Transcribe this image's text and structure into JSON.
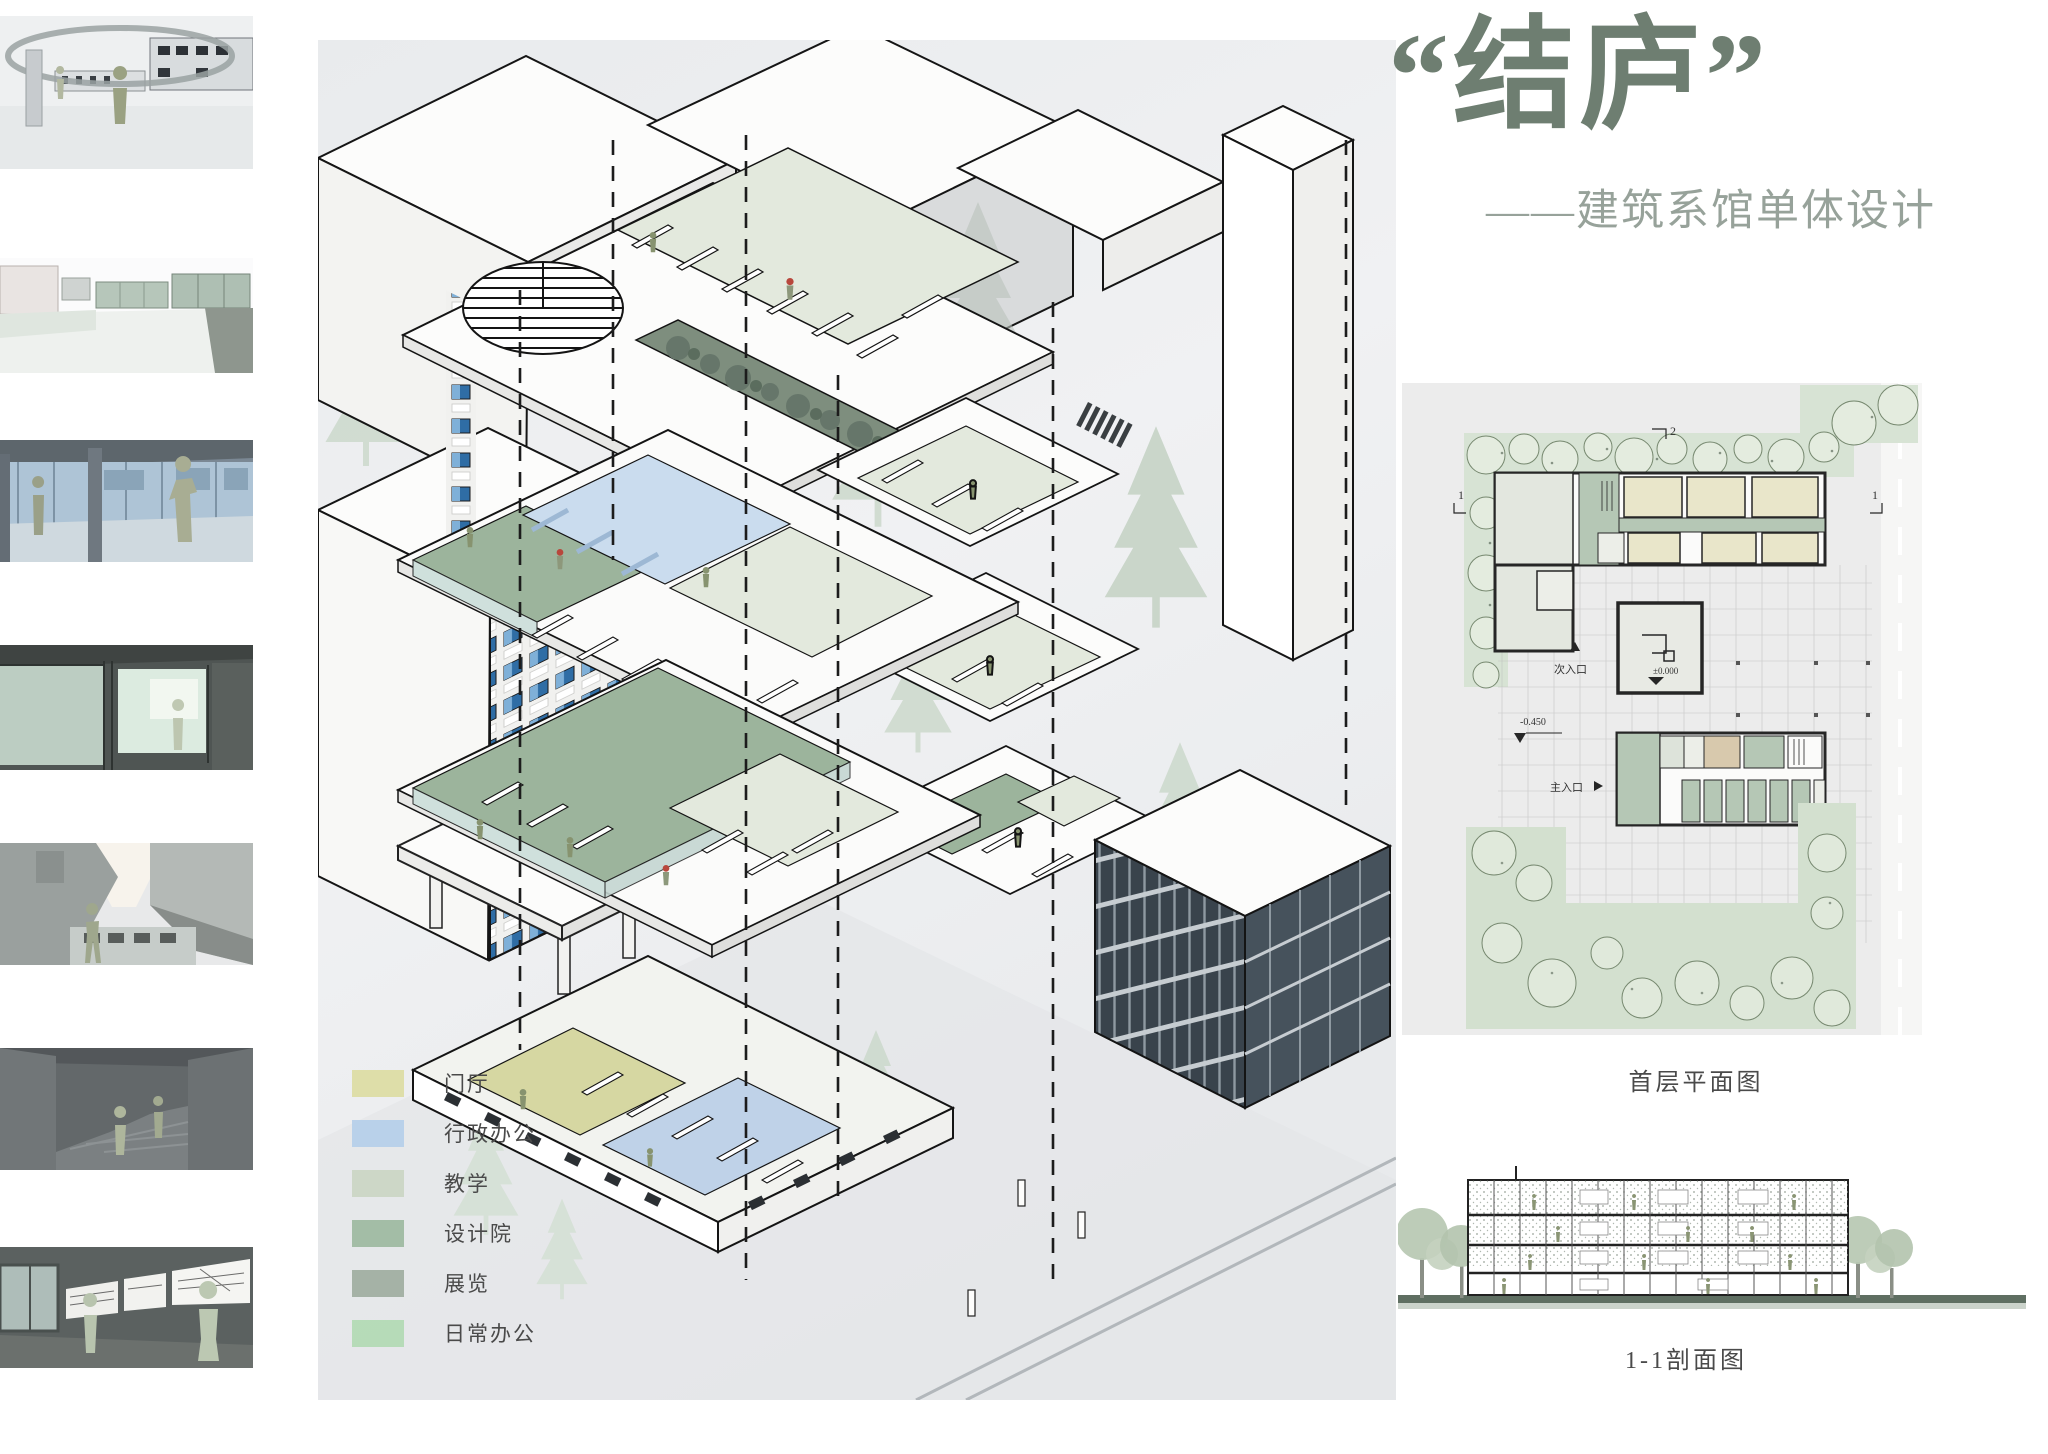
{
  "page": {
    "title": "“结庐”",
    "subtitle": "——建筑系馆单体设计"
  },
  "thumbnails": [
    {
      "name": "perspective-render-entry-ring"
    },
    {
      "name": "perspective-render-roof-terrace"
    },
    {
      "name": "perspective-render-glazed-colonnade"
    },
    {
      "name": "perspective-render-interior-green-glass"
    },
    {
      "name": "perspective-render-courtyard-canyon"
    },
    {
      "name": "perspective-render-stair-hall"
    },
    {
      "name": "perspective-render-exhibition-corridor"
    }
  ],
  "axon": {
    "legend": {
      "items": [
        {
          "label": "门厅",
          "color": "#dcdca3"
        },
        {
          "label": "行政办公",
          "color": "#b5cee9"
        },
        {
          "label": "教学",
          "color": "#cbd5c3"
        },
        {
          "label": "设计院",
          "color": "#9db89f"
        },
        {
          "label": "展览",
          "color": "#9fad9f"
        },
        {
          "label": "日常办公",
          "color": "#b2dab3"
        }
      ]
    }
  },
  "plan": {
    "caption": "首层平面图",
    "labels": {
      "section_mark_top": "2",
      "section_mark_left": "1",
      "section_mark_right": "1",
      "level_main": "±0.000",
      "level_entry": "-0.450",
      "main_entrance": "主入口",
      "secondary_entrance": "次入口"
    }
  },
  "section": {
    "caption": "1-1剖面图"
  },
  "colors": {
    "title_green": "#6e7e71",
    "panel_gray": "#eceef0",
    "deck_green": "#9cb49c",
    "pale_room_green": "#e3e9dd",
    "lobby_khaki": "#d6d7a2",
    "admin_blue": "#bfd2e8",
    "glass_teal": "#cfe0dc",
    "window_blue": "#2f6da5",
    "tree_pale": "#ccd8cc",
    "ground_section": "#5f6f62"
  }
}
